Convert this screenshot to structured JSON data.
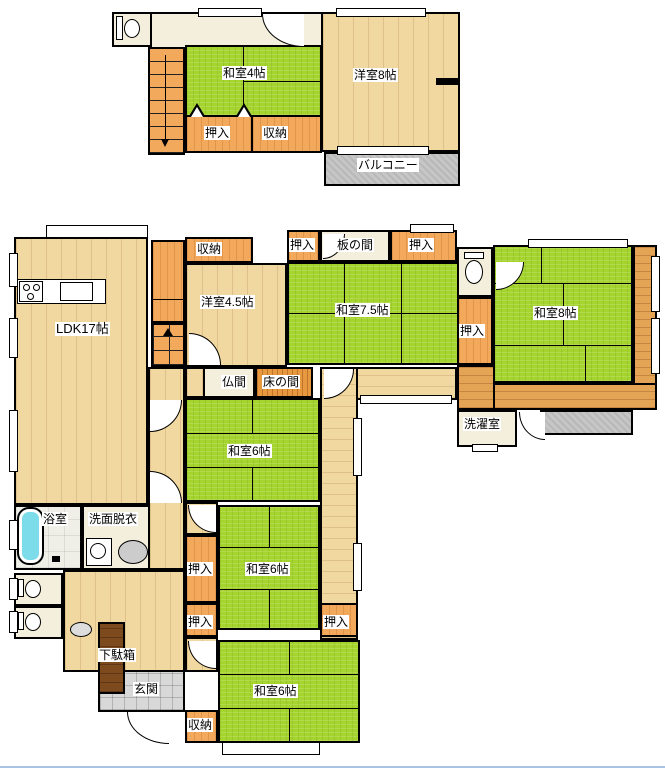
{
  "title": "2-story Japanese house floor plan",
  "floor2": {
    "washitsu4": "和室4帖",
    "youshitsu8": "洋室8帖",
    "oshiire": "押入",
    "shuunou": "収納",
    "balcony": "バルコニー"
  },
  "floor1": {
    "ldk": "LDK17帖",
    "shuunou_top": "収納",
    "oshiire": "押入",
    "itanoma": "板の間",
    "youshitsu45": "洋室4.5帖",
    "washitsu75": "和室7.5帖",
    "washitsu8": "和室8帖",
    "butsuma": "仏間",
    "tokonoma": "床の間",
    "washitsu6": "和室6帖",
    "sentaku": "洗濯室",
    "yokushitsu": "浴室",
    "senmen": "洗面脱衣",
    "getabako": "下駄箱",
    "genkan": "玄関",
    "shuunou_btm": "収納"
  },
  "colors": {
    "tatami": "#a6d42f",
    "wood_floor": "#f1d7a0",
    "engawa_wood": "#e3a455",
    "closet_orange": "#f3a95c",
    "tokonoma_wood": "#e8993f",
    "cream_floor": "#f3efdc",
    "genkan_tile": "#d8d8d8",
    "balcony_gray": "#c6c6c6",
    "getabako_brown": "#7d4a1e",
    "bathtub_cyan": "#7ddcea",
    "wall": "#000000"
  },
  "icons": {
    "toilet": "toilet-icon",
    "bathtub": "bathtub-icon",
    "stove": "stove-burners-icon",
    "sink": "sink-icon",
    "washer": "washing-machine-icon",
    "stairs_down_arrow": "stairs-down-arrow",
    "stairs_up_mark": "stairs-up-mark"
  }
}
